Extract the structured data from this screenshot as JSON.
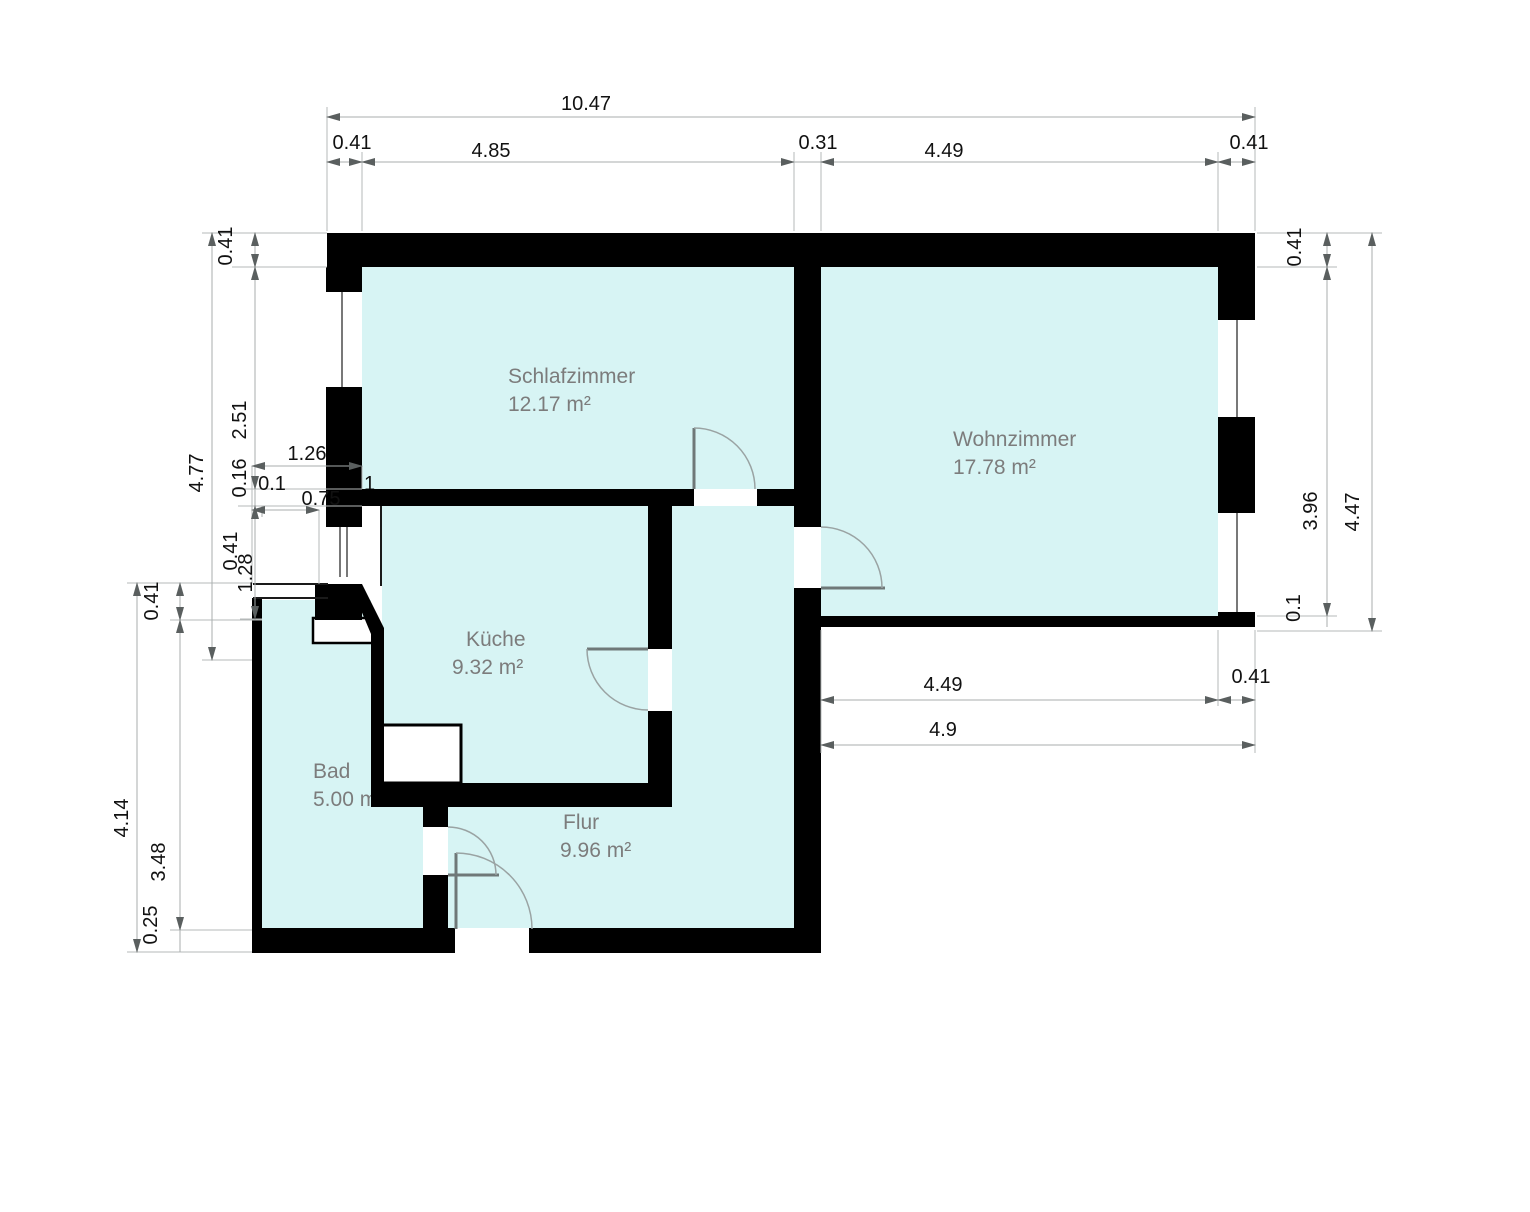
{
  "plan_type": "apartment-floor-plan",
  "colors": {
    "floor_fill": "#d7f4f4",
    "wall": "#000000",
    "dimension_line": "#a9aeae",
    "dimension_text": "#111111",
    "room_label": "#7c7c7c",
    "background": "#ffffff"
  },
  "rooms": [
    {
      "name": "Schlafzimmer",
      "area": "12.17 m²"
    },
    {
      "name": "Wohnzimmer",
      "area": "17.78 m²"
    },
    {
      "name": "Küche",
      "area": "9.32 m²"
    },
    {
      "name": "Bad",
      "area": "5.00 m²"
    },
    {
      "name": "Flur",
      "area": "9.96 m²"
    }
  ],
  "dims": {
    "total_width": "10.47",
    "top": [
      "0.41",
      "4.85",
      "0.31",
      "4.49",
      "0.41"
    ],
    "left_total": "4.77",
    "left_wall_top": "0.41",
    "left_schlaf": "2.51",
    "left_wall_mid": "0.16",
    "left_small": "0.1",
    "left_offset_a": "1.26",
    "left_offset_b": "0.75",
    "left_small2": "0.41",
    "left_lobby": "1.28",
    "left_stray": "1",
    "lower_left_total": "4.14",
    "lower_left_wall": "0.41",
    "lower_left_bad": "3.48",
    "lower_left_bottom": "0.25",
    "right_total": "4.47",
    "right_wall_top": "0.41",
    "right_window": "3.96",
    "right_thin": "0.1",
    "right_wall_width": "0.41",
    "bottom_inner": "4.49",
    "bottom_outer": "4.9"
  }
}
